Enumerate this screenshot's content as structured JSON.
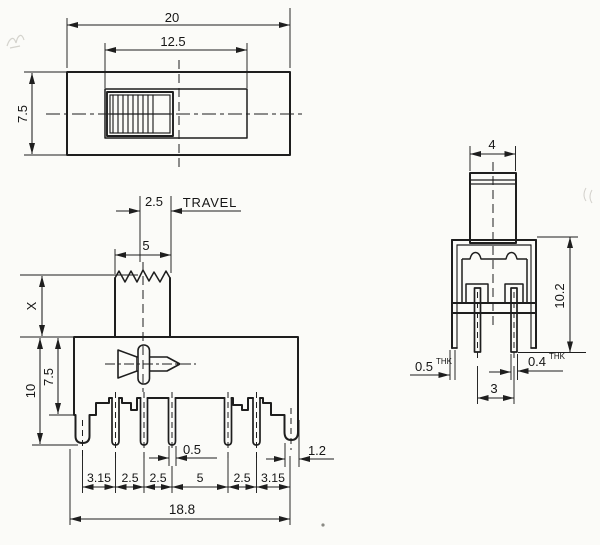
{
  "drawing": {
    "top_view": {
      "width": "20",
      "slider_width": "12.5",
      "depth": "7.5"
    },
    "front_view": {
      "travel_value": "2.5",
      "travel_word": "TRAVEL",
      "knob_width": "5",
      "shaft_height": "X",
      "total_height": "10",
      "body_height": "7.5",
      "pin_width": "0.5",
      "pitch": [
        "3.15",
        "2.5",
        "2.5",
        "5",
        "2.5",
        "3.15"
      ],
      "overall_width": "18.8",
      "corner_offset": "1.2"
    },
    "side_view": {
      "knob_depth": "4",
      "overall_height": "10.2",
      "frame_thickness": "0.5",
      "frame_thickness_suffix": "THK",
      "pin_thickness": "0.4",
      "pin_thickness_suffix": "THK",
      "pin_spacing": "3"
    },
    "colors": {
      "line": "#1e1e1e",
      "paper": "#fbfbf8"
    }
  }
}
